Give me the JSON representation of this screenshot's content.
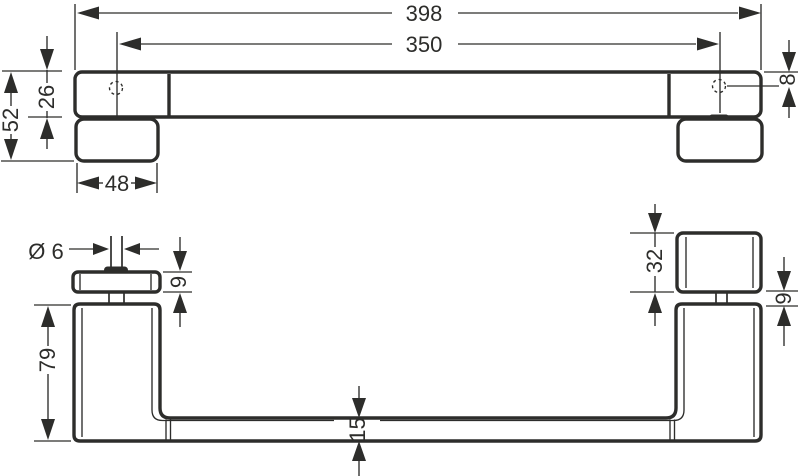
{
  "drawing": {
    "kind": "technical-dimension-drawing",
    "background": "#ffffff",
    "line_color": "#2d2d2b",
    "top_view": {
      "overall_length": "398",
      "hole_spacing": "350",
      "total_depth": "52",
      "bar_depth": "26",
      "mount_plate_width": "48",
      "edge_to_hole": "8"
    },
    "side_view": {
      "screw_diameter": "Ø 6",
      "flange_thickness": "9",
      "post_height": "79",
      "bar_thickness": "15",
      "clamp_block_height": "32",
      "stem_gap": "9"
    }
  }
}
